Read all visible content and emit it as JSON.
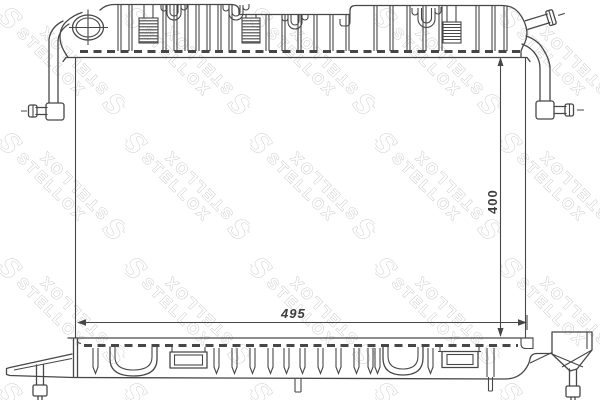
{
  "watermark": {
    "text": "STELLOX",
    "logo_glyph": "S",
    "color": "#cbcbcb",
    "angle_deg": 45
  },
  "drawing": {
    "line_color": "#474747",
    "background": "#ffffff",
    "dimensions": {
      "width_label": "495",
      "height_label": "400"
    }
  }
}
